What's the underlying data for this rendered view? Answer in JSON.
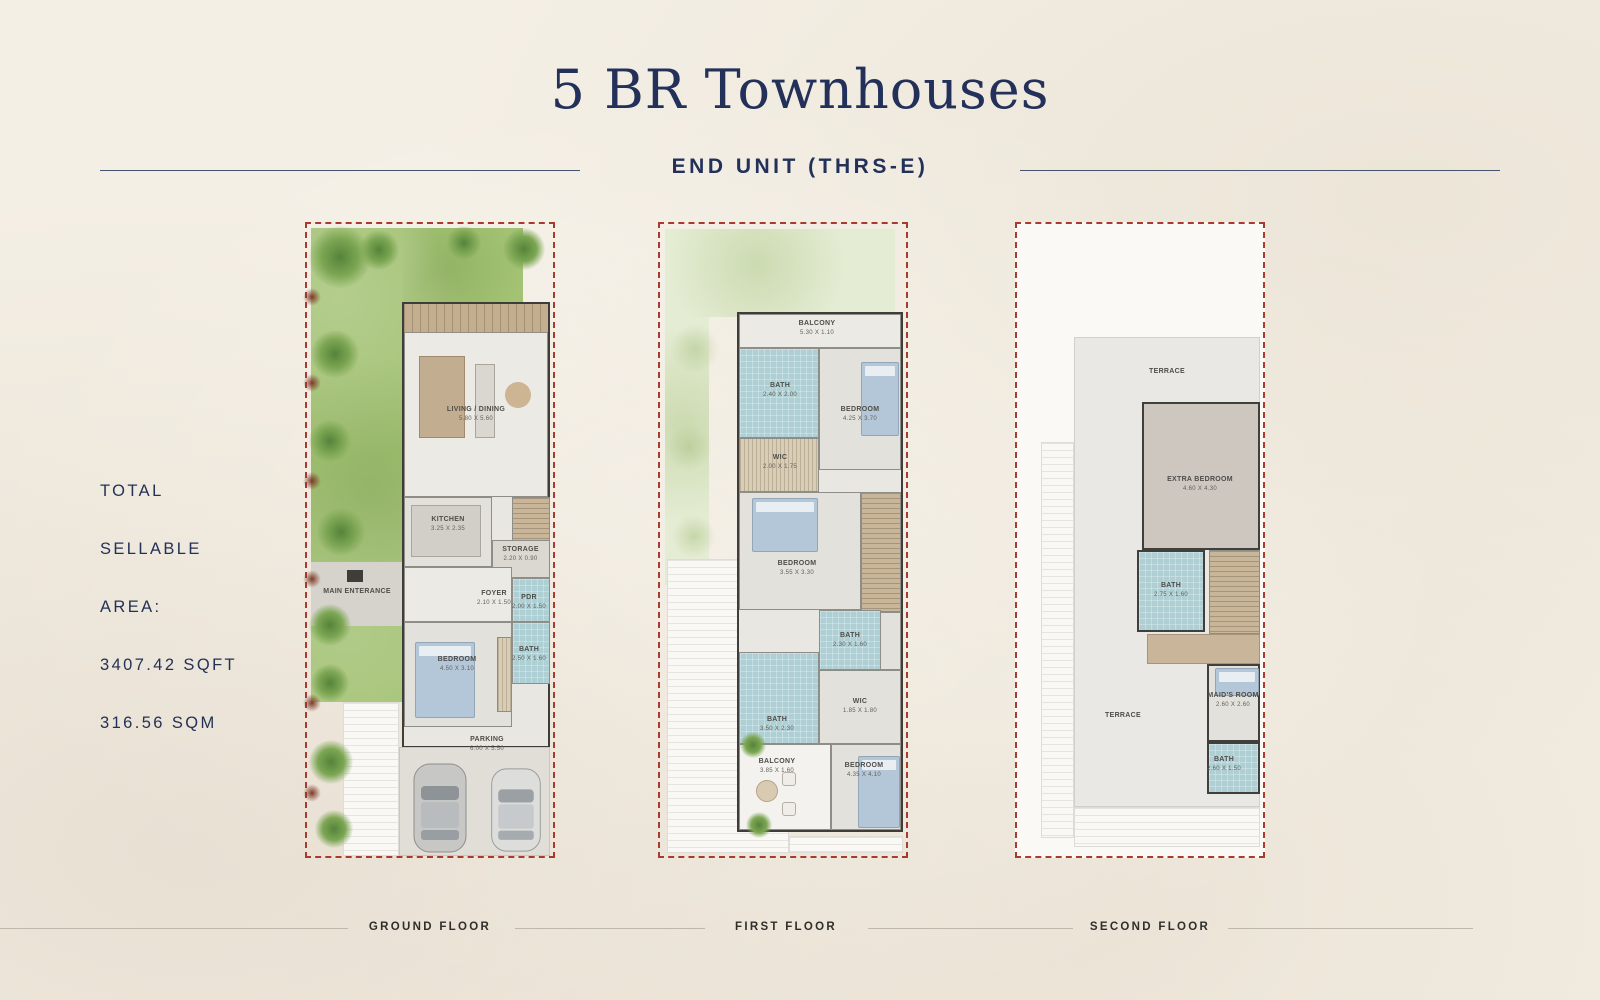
{
  "header": {
    "title": "5 BR Townhouses",
    "subtitle": "END UNIT (THRS-E)"
  },
  "info": {
    "lines": [
      "TOTAL",
      "SELLABLE",
      "AREA:",
      "3407.42 SQFT",
      "316.56 SQM"
    ]
  },
  "colors": {
    "navy": "#22305a",
    "dashed_red": "#a93a2e",
    "garden_green": "#a3c274",
    "bath_teal": "#aecfd3",
    "wood_tan": "#c9b699",
    "paper": "#f4efe5"
  },
  "floors": [
    {
      "caption": "GROUND FLOOR",
      "labels": {
        "living": {
          "name": "LIVING / DINING",
          "dims": "5.80 X 5.60"
        },
        "kitchen": {
          "name": "KITCHEN",
          "dims": "3.25 X 2.35"
        },
        "storage": {
          "name": "STORAGE",
          "dims": "2.20 X 0.90"
        },
        "entrance": {
          "name": "MAIN ENTERANCE",
          "dims": ""
        },
        "foyer": {
          "name": "FOYER",
          "dims": "2.10 X 1.50"
        },
        "pdr": {
          "name": "PDR",
          "dims": "2.00 X 1.50"
        },
        "bedroom": {
          "name": "BEDROOM",
          "dims": "4.50 X 3.10"
        },
        "bath": {
          "name": "BATH",
          "dims": "2.50 X 1.60"
        },
        "parking": {
          "name": "PARKING",
          "dims": "6.00 X 5.50"
        }
      }
    },
    {
      "caption": "FIRST FLOOR",
      "labels": {
        "balcony_top": {
          "name": "BALCONY",
          "dims": "5.30 X 1.10"
        },
        "bath1": {
          "name": "BATH",
          "dims": "2.40 X 2.00"
        },
        "bedroom1": {
          "name": "BEDROOM",
          "dims": "4.25 X 3.70"
        },
        "wic1": {
          "name": "WIC",
          "dims": "2.00 X 1.75"
        },
        "bedroom2": {
          "name": "BEDROOM",
          "dims": "3.55 X 3.30"
        },
        "bath2": {
          "name": "BATH",
          "dims": "2.30 X 1.60"
        },
        "bath3": {
          "name": "BATH",
          "dims": "3.50 X 2.30"
        },
        "wic2": {
          "name": "WIC",
          "dims": "1.85 X 1.80"
        },
        "balcony_bottom": {
          "name": "BALCONY",
          "dims": "3.85 X 1.60"
        },
        "bedroom3": {
          "name": "BEDROOM",
          "dims": "4.35 X 4.10"
        }
      }
    },
    {
      "caption": "SECOND FLOOR",
      "labels": {
        "terrace_top": {
          "name": "TERRACE",
          "dims": ""
        },
        "extra_bedroom": {
          "name": "EXTRA BEDROOM",
          "dims": "4.60 X 4.30"
        },
        "bath1": {
          "name": "BATH",
          "dims": "2.75 X 1.60"
        },
        "maids_room": {
          "name": "MAID'S ROOM",
          "dims": "2.60 X 2.60"
        },
        "terrace_left": {
          "name": "TERRACE",
          "dims": ""
        },
        "bath2": {
          "name": "BATH",
          "dims": "2.60 X 1.50"
        }
      }
    }
  ]
}
